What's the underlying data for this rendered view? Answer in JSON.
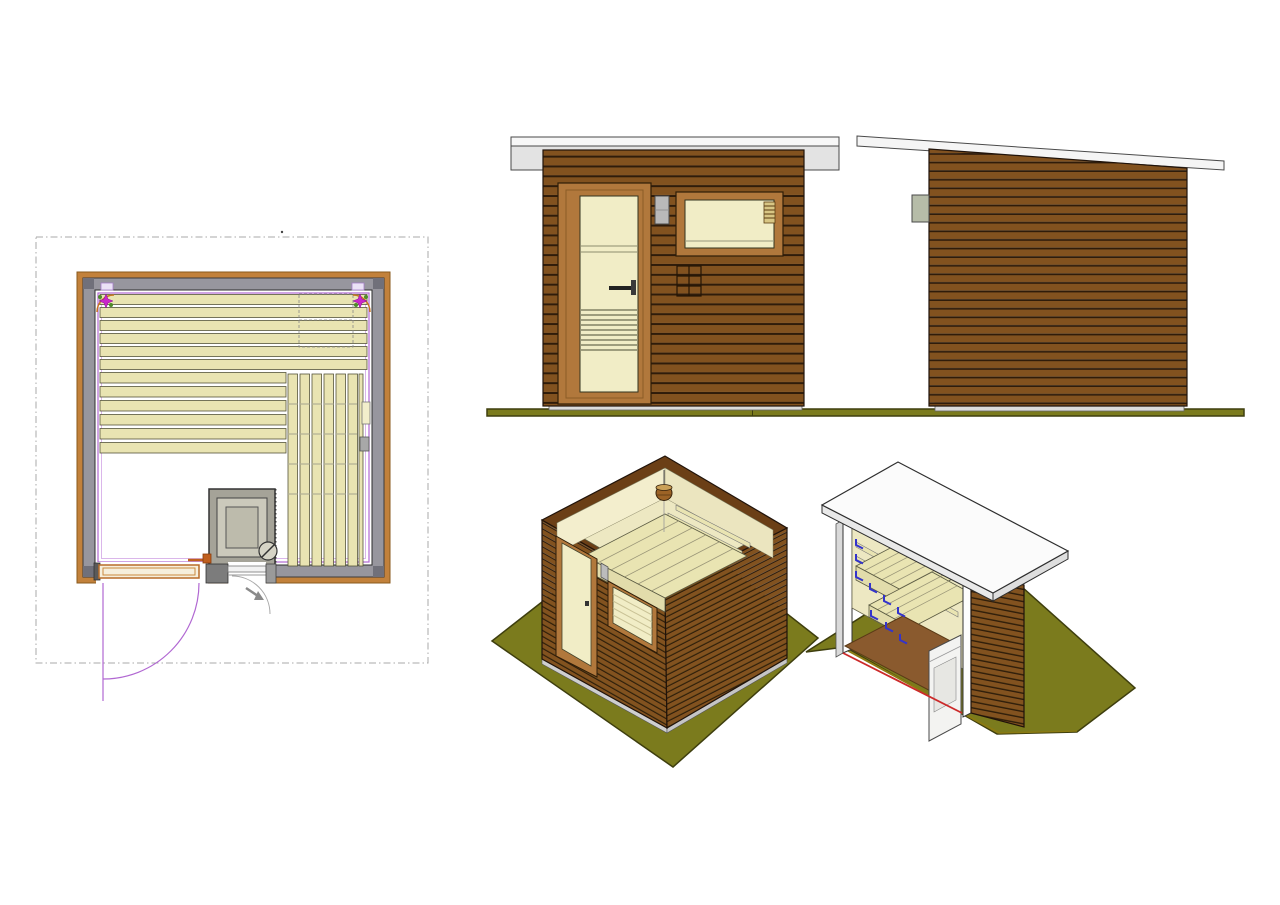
{
  "document": {
    "type": "architectural-drawing",
    "subject": "small sauna cabin, multi-view CAD sheet",
    "views": [
      {
        "id": "floor-plan",
        "label": "floor plan",
        "elements": [
          "wall-ring",
          "interior-lining",
          "bench-slats-horizontal",
          "bench-slats-vertical",
          "sauna-stove",
          "stove-dial",
          "entry-door-leaf",
          "door-swing-arc",
          "window-vent-arc",
          "ceiling-light-symbol-left",
          "ceiling-light-symbol-right"
        ],
        "horizontal_slat_count": 12,
        "vertical_slat_count": 7
      },
      {
        "id": "front-elevation",
        "label": "front elevation",
        "elements": [
          "flat-roof-slab",
          "wall-cladding-slats",
          "glazed-door",
          "door-handle",
          "wall-lamp",
          "window",
          "window-vent-insert",
          "vent-grille",
          "base-sill",
          "ground-line"
        ],
        "wall_slat_count": 26
      },
      {
        "id": "side-elevation",
        "label": "side elevation",
        "elements": [
          "mono-pitch-roof-slab",
          "wall-cladding-slats",
          "wall-lamp",
          "base-sill",
          "ground-line"
        ],
        "wall_slat_count": 30
      },
      {
        "id": "isometric-open-top",
        "label": "isometric view with roof removed",
        "elements": [
          "ground-pad",
          "front-face-door",
          "front-face-window",
          "side-face-slats",
          "interior-walls",
          "bench-platform",
          "backrest-slats",
          "sauna-bucket",
          "wall-lamp"
        ]
      },
      {
        "id": "isometric-cutaway",
        "label": "isometric section view",
        "elements": [
          "ground-pad",
          "roof-slab",
          "cut-wall-faces",
          "interior-wall",
          "ceiling-slats",
          "upper-bench",
          "lower-bench",
          "bench-brackets-blue",
          "floor-deck",
          "sauna-heater",
          "section-cut-line-red"
        ]
      }
    ]
  },
  "colors": {
    "wood_slat": "#82521f",
    "wood_gap": "#2f1c0a",
    "frame": "#b1783c",
    "glass": "#f1edc6",
    "interior": "#ede8c2",
    "bench": "#e9e4b2",
    "roof_white": "#f7f7f7",
    "roof_gray": "#e3e3e3",
    "ground": "#7b7b1d",
    "ground_edge": "#3e3e0e",
    "plan_ring": "#c2813b",
    "plan_gray": "#97969e",
    "lining": "#b168d2",
    "magenta": "#c926c9",
    "stove_outer": "#a5a398",
    "stove_inner": "#cbc9bb",
    "floor": "#8a5a2e",
    "blue": "#3333cc",
    "cut_red": "#cc2a2a",
    "lamp": "#b9b9b9"
  }
}
